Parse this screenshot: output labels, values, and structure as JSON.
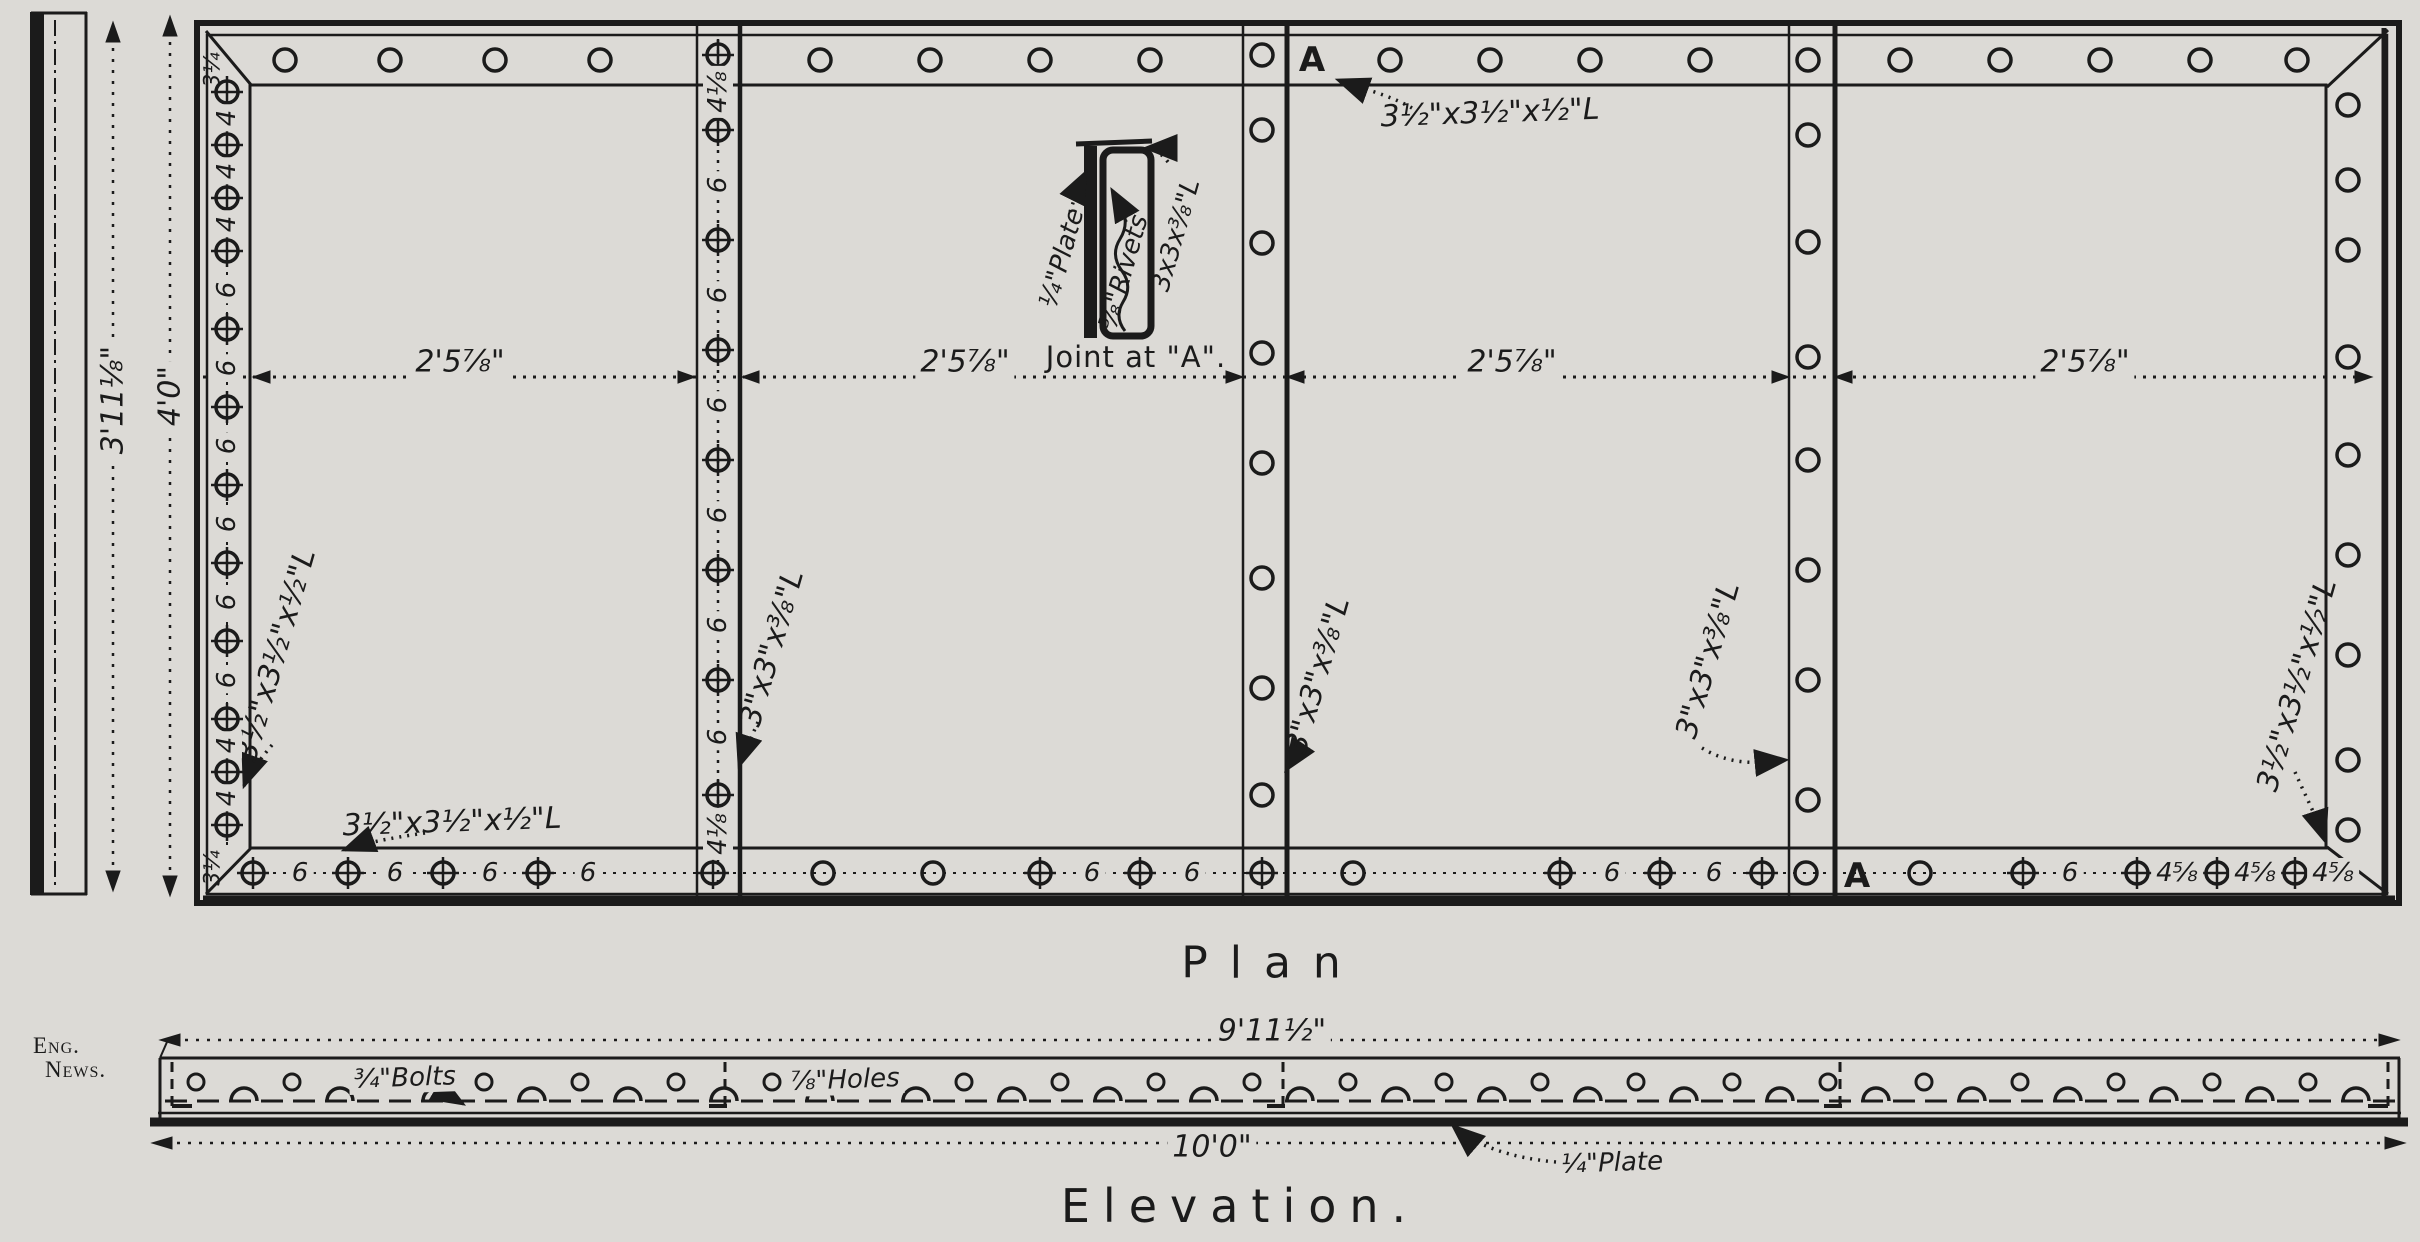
{
  "drawing": {
    "plan_title": "Plan",
    "elevation_title": "Elevation.",
    "credit": {
      "line1": "Eng.",
      "line2": "News."
    },
    "section_marker": "A",
    "joint_detail": {
      "caption": "Joint at \"A\".",
      "plate_label": "¼\"Plate",
      "rivets_label": "⅝\"Rivets",
      "angle_label": "3x3x⅜\"L"
    },
    "plan": {
      "height_inner": "3'11⅛\"",
      "height_outer": "4'0\"",
      "panel_widths": [
        "2'5⅞\"",
        "2'5⅞\"",
        "2'5⅞\"",
        "2'5⅞\""
      ],
      "edge_angle": "3½\"x3½\"x½\"L",
      "stiffener_angle": "3\"x3\"x⅜\"L",
      "corner_gauge": "3¼",
      "left_gaps": [
        "4",
        "4",
        "4",
        "6",
        "6",
        "6",
        "6",
        "6",
        "6",
        "4",
        "4"
      ],
      "seam1_gaps": [
        "4⅛",
        "6",
        "6",
        "6",
        "6",
        "6",
        "6",
        "4⅛"
      ],
      "bottom_gaps_p1": [
        "6",
        "6",
        "6",
        "6"
      ],
      "bottom_gaps_p2": [
        "6",
        "6"
      ],
      "bottom_gaps_p3": [
        "6",
        "6"
      ],
      "bottom_gaps_p4": [
        "6",
        "4⅝",
        "4⅝",
        "4⅝"
      ]
    },
    "elevation": {
      "length_top": "9'11½\"",
      "length_bottom": "10'0\"",
      "bolts_label": "¾\"Bolts",
      "holes_label": "⅞\"Holes",
      "plate_label": "¼\"Plate"
    },
    "colors": {
      "paper": "#dcdad6",
      "ink": "#1b1b1b"
    }
  }
}
